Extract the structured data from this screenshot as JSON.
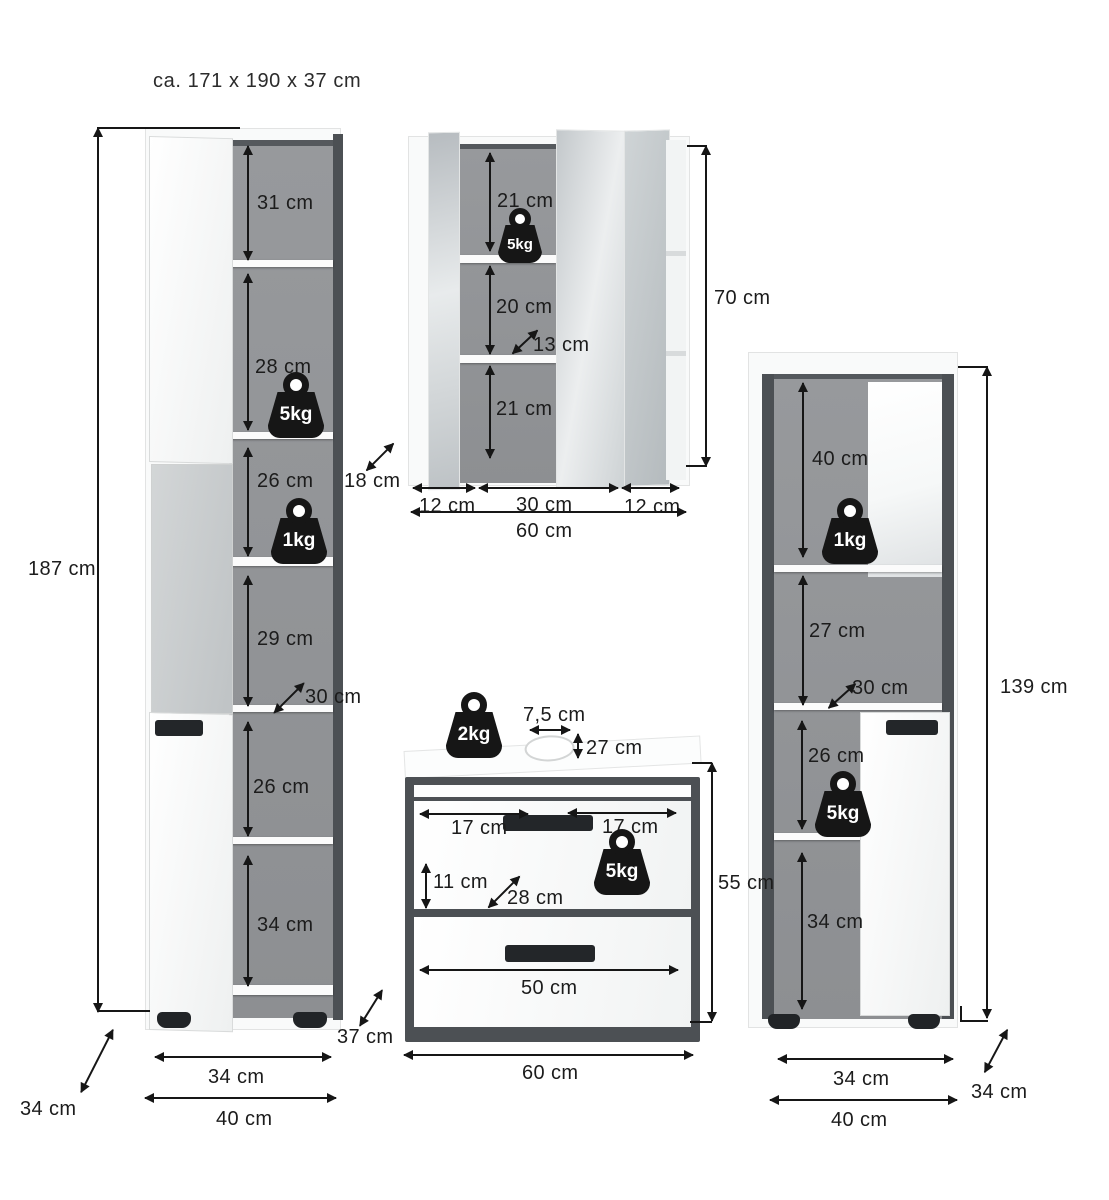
{
  "title": "ca. 171 x 190 x 37 cm",
  "tall_cabinet": {
    "height": "187 cm",
    "shelf_31": "31 cm",
    "shelf_28": "28 cm",
    "shelf_26_top": "26 cm",
    "shelf_29": "29 cm",
    "shelf_26_bottom": "26 cm",
    "shelf_34": "34 cm",
    "depth_inner": "30 cm",
    "weight_top": "5kg",
    "weight_mid": "1kg",
    "width_inner": "34 cm",
    "width_outer": "40 cm",
    "depth_side": "34 cm",
    "depth_right": "37 cm"
  },
  "mirror_cabinet": {
    "shelf_top": "21 cm",
    "shelf_mid": "20 cm",
    "shelf_bottom": "21 cm",
    "inner_depth": "13 cm",
    "weight": "5kg",
    "height": "70 cm",
    "door_left": "12 cm",
    "door_center": "30 cm",
    "door_right": "12 cm",
    "total_width": "60 cm",
    "side_depth": "18 cm"
  },
  "sink_cabinet": {
    "weight_top": "2kg",
    "hole_width": "7,5 cm",
    "hole_offset": "27 cm",
    "handle_left": "17 cm",
    "handle_right": "17 cm",
    "weight_drawer": "5kg",
    "drawer_front": "11 cm",
    "inner_depth": "28 cm",
    "height": "55 cm",
    "drawer_width": "50 cm",
    "total_width": "60 cm"
  },
  "side_cabinet": {
    "shelf_40": "40 cm",
    "shelf_27": "27 cm",
    "shelf_26": "26 cm",
    "shelf_34": "34 cm",
    "depth_inner": "30 cm",
    "weight_top": "1kg",
    "weight_bottom": "5kg",
    "height": "139 cm",
    "width_inner": "34 cm",
    "width_outer": "40 cm",
    "depth_side": "34 cm"
  }
}
